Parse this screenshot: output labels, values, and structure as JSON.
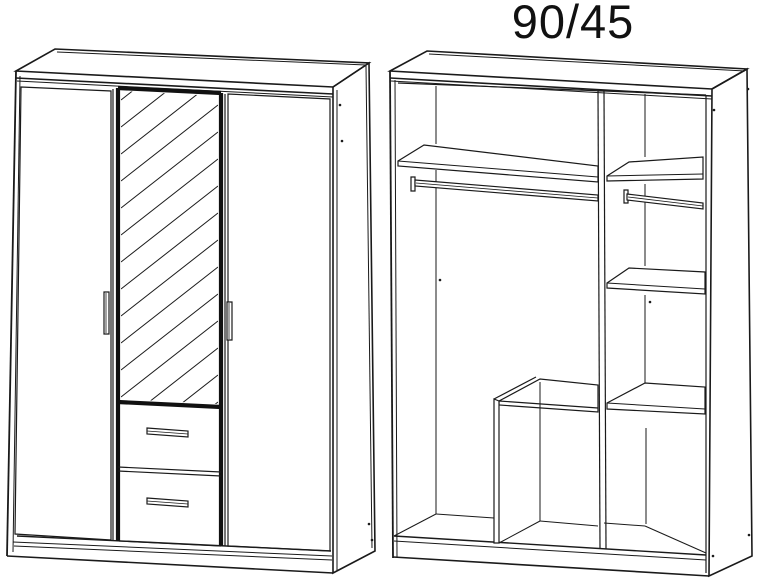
{
  "title": "90/45",
  "figure": {
    "type": "technical-line-drawing",
    "line_color": "#1a1a1a",
    "background_color": "#ffffff",
    "views": [
      {
        "id": "wardrobe-exterior-view",
        "description": "three-door wardrobe front: left door, centre mirror door with two drawers below, right door, plinth base"
      },
      {
        "id": "wardrobe-interior-view",
        "description": "open carcass: left bay with top shelf and hanging rail, centre drawer box, full-height divider, right bay with three shelves and hanging rail"
      }
    ]
  }
}
